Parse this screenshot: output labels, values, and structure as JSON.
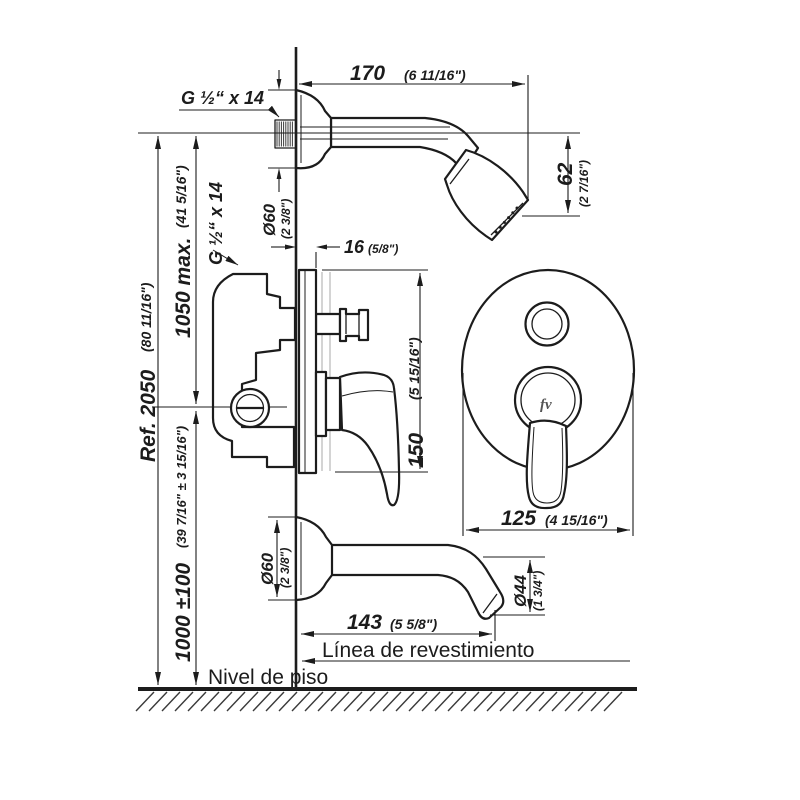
{
  "drawing": {
    "labels": {
      "thread_shower": "G ½“ x 14",
      "thread_valve": "G ½“ x 14",
      "finish_line": "Línea de revestimiento",
      "floor_level": "Nivel de piso",
      "brand_logo": "fv"
    },
    "dimensions": {
      "arm_length_mm": "170",
      "arm_length_in": "(6 11/16\")",
      "head_drop_mm": "62",
      "head_drop_in": "(2 7/16\")",
      "shower_flange_mm": "Ø60",
      "shower_flange_in": "(2 3/8\")",
      "plate_depth_mm": "16",
      "plate_depth_in": "(5/8\")",
      "plate_height_mm": "150",
      "plate_height_in": "(5 15/16\")",
      "plate_width_mm": "125",
      "plate_width_in": "(4 15/16\")",
      "spout_flange_mm": "Ø60",
      "spout_flange_in": "(2 3/8\")",
      "spout_length_mm": "143",
      "spout_length_in": "(5 5/8\")",
      "spout_dia_mm": "Ø44",
      "spout_dia_in": "(1 3/4\")",
      "total_height_mm": "Ref. 2050",
      "total_height_in": "(80 11/16\")",
      "mixer_height_mm": "1050 max.",
      "mixer_height_in": "(41 5/16\")",
      "spout_height_mm": "1000 ±100",
      "spout_height_in": "(39 7/16\" ± 3 15/16\")"
    }
  }
}
